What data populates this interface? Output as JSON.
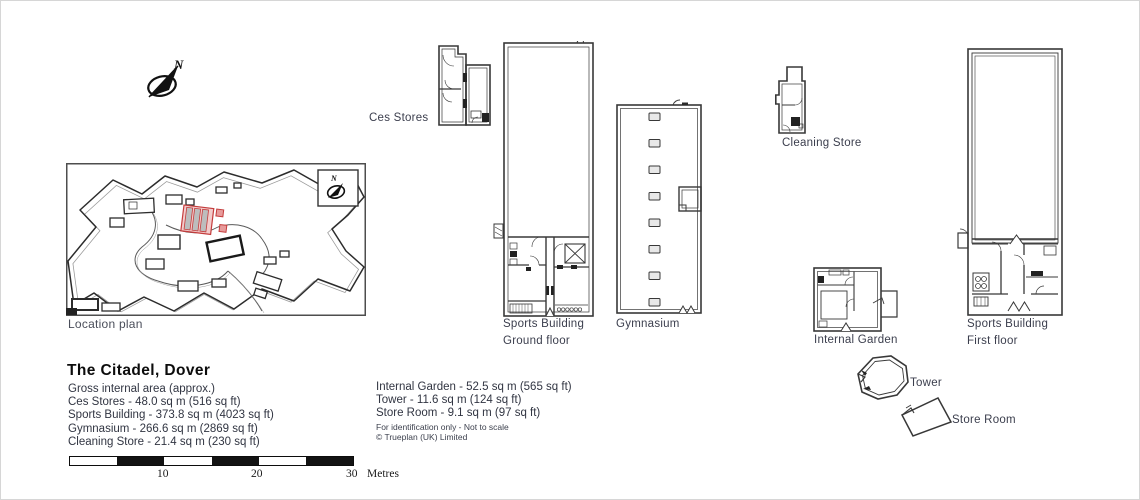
{
  "document": {
    "type_label": "floorplan",
    "title": "The Citadel, Dover"
  },
  "colors": {
    "line": "#383838",
    "label_text": "#3b3e4d",
    "highlight_stroke": "#c43c3c",
    "highlight_fill": "#f3cbcb",
    "highlight_bar_fill": "#bdbdbd"
  },
  "compass": {
    "letter": "N"
  },
  "location_plan": {
    "label": "Location plan"
  },
  "buildings": {
    "ces_stores": {
      "label": "Ces Stores"
    },
    "sports_gf": {
      "label_line1": "Sports Building",
      "label_line2": "Ground floor"
    },
    "gymnasium": {
      "label": "Gymnasium"
    },
    "cleaning_store": {
      "label": "Cleaning Store"
    },
    "internal_garden": {
      "label": "Internal Garden"
    },
    "sports_ff": {
      "label_line1": "Sports Building",
      "label_line2": "First floor"
    },
    "tower": {
      "label": "Tower"
    },
    "store_room": {
      "label": "Store Room"
    }
  },
  "title_block": {
    "title": "The Citadel, Dover",
    "subtitle": "Gross internal area (approx.)",
    "areas": [
      "Ces Stores - 48.0 sq m (516 sq ft)",
      "Sports Building - 373.8 sq m (4023 sq ft)",
      "Gymnasium - 266.6 sq m (2869 sq ft)",
      "Cleaning Store - 21.4 sq m (230 sq ft)"
    ]
  },
  "areas_block_2": {
    "areas": [
      "Internal Garden - 52.5 sq m (565 sq ft)",
      "Tower - 11.6 sq m (124 sq ft)",
      "Store Room - 9.1 sq m (97 sq ft)"
    ],
    "disclaimer": "For identification only - Not to scale",
    "copyright": "© Trueplan (UK) Limited"
  },
  "scale_bar": {
    "ticks": [
      "10",
      "20",
      "30"
    ],
    "unit": "Metres"
  }
}
